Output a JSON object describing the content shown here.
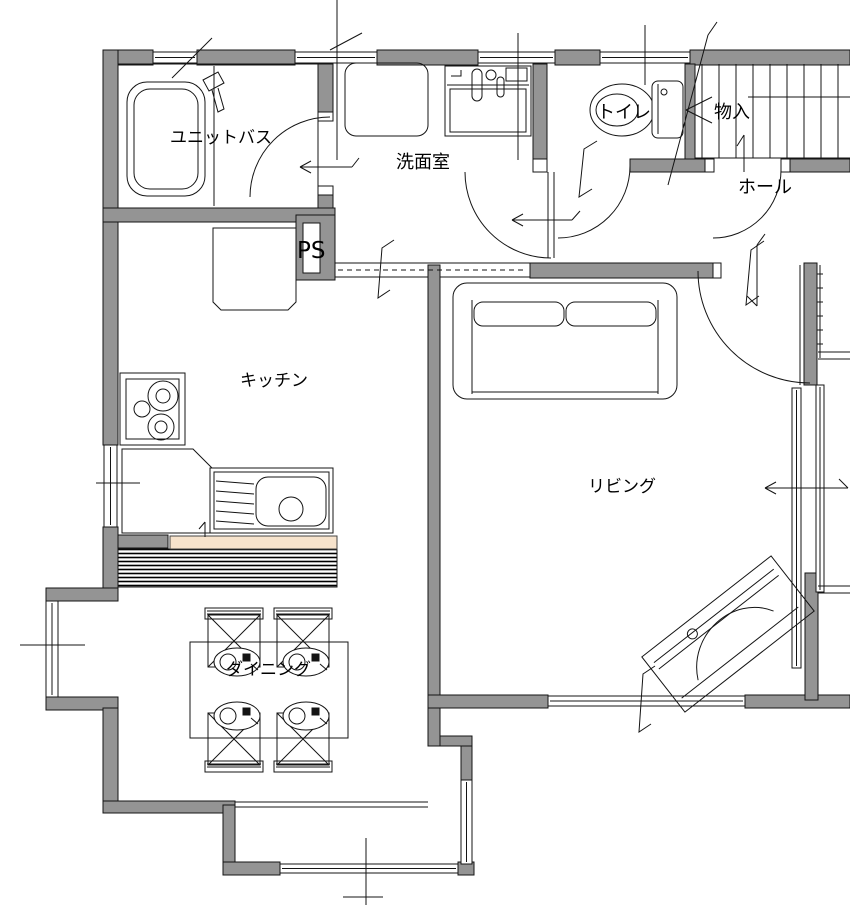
{
  "plan": {
    "type": "floor-plan",
    "rooms": {
      "unit_bath": "ユニットバス",
      "washroom": "洗面室",
      "toilet": "トイレ",
      "storage": "物入",
      "hall": "ホール",
      "pipe_space": "PS",
      "kitchen": "キッチン",
      "living": "リビング",
      "dining": "ダイニング"
    },
    "fixtures": [
      "bathtub",
      "shower-head",
      "washing-machine-pan",
      "vanity-sink",
      "toilet-bowl",
      "staircase",
      "refrigerator",
      "gas-stove",
      "kitchen-sink",
      "kitchen-counter",
      "dining-table",
      "dining-chair",
      "place-setting",
      "sofa",
      "piano",
      "sliding-window",
      "hinged-door"
    ],
    "colors": {
      "background": "#ffffff",
      "wall_fill": "#949494",
      "line": "#141414",
      "counter_accent": "#f7e3cc"
    }
  }
}
